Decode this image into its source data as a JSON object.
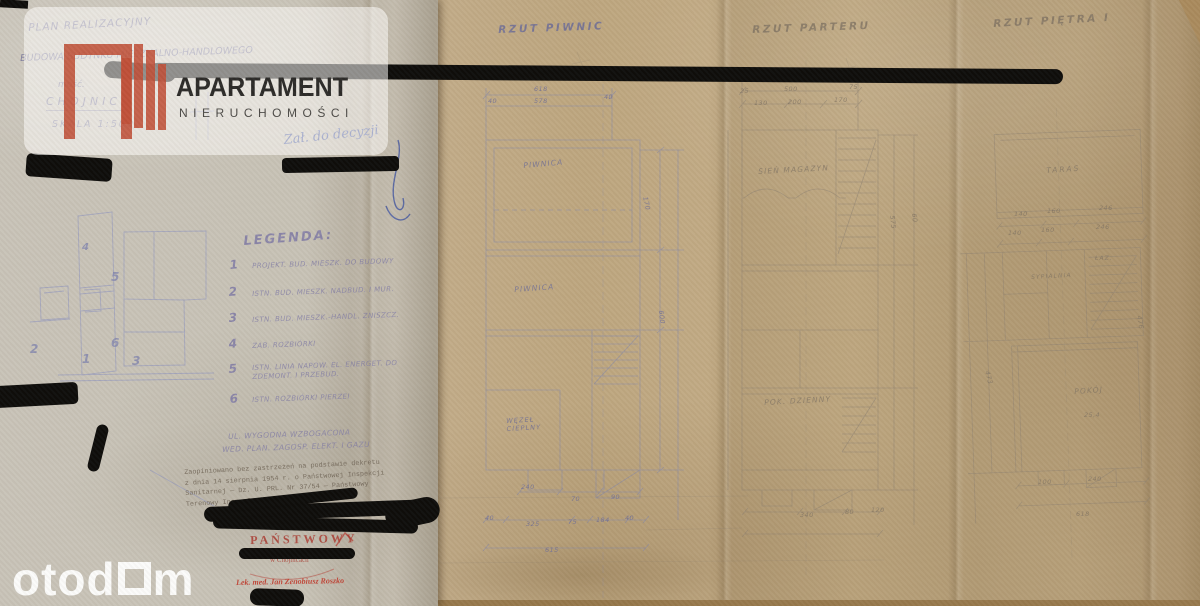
{
  "logo": {
    "title": "APARTAMENT",
    "subtitle": "NIERUCHOMOŚCI",
    "brand_color": "#bf4f37"
  },
  "footer_watermark": {
    "part1": "otod",
    "part2": "m",
    "full_name": "otodom"
  },
  "title_block": {
    "line1": "PLAN REALIZACYJNY",
    "line2": "BUDOWA BUDYNKU MIESZKALNO-HANDLOWEGO",
    "line3": "mość.",
    "line4": "CHOJNICE",
    "line5": "SKALA 1:500"
  },
  "ink_note": {
    "text": "Zał. do decyzji"
  },
  "legend": {
    "title": "LEGENDA:",
    "items": [
      {
        "num": "1",
        "text": "PROJEKT. BUD. MIESZK. DO BUDOWY"
      },
      {
        "num": "2",
        "text": "ISTN. BUD. MIESZK. NADBUD. I MUR."
      },
      {
        "num": "3",
        "text": "ISTN. BUD. MIESZK.-HANDL. ZNISZCZ."
      },
      {
        "num": "4",
        "text": "ZAB. ROZBIÓRKI"
      },
      {
        "num": "5",
        "text": "ISTN. LINIA NAPOW. EL. ENERGET. DO ZDEMONT. I PRZEBUD."
      },
      {
        "num": "6",
        "text": "ISTN. ROZBIÓRKI PIERZEI"
      }
    ],
    "footnote1": "UL. WYGODNA WZBOGACONA",
    "footnote2": "WED. PLAN. ZAGOSP. ELEKT. I GAZU"
  },
  "site_plan": {
    "labels": [
      "4",
      "5",
      "6",
      "1",
      "3",
      "2"
    ]
  },
  "plans": [
    {
      "title": "RZUT PIWNIC",
      "rooms": [
        "PIWNICA",
        "PIWNICA",
        "WĘZEŁ CIEPLNY"
      ],
      "dims": [
        "618",
        "578",
        "40",
        "40",
        "170",
        "600",
        "240",
        "70",
        "90",
        "40",
        "325",
        "75",
        "184",
        "40",
        "615"
      ]
    },
    {
      "title": "RZUT PARTERU",
      "rooms": [
        "SIEŃ MAGAZYN",
        "POK. DZIENNY"
      ],
      "dims": [
        "618",
        "500",
        "25",
        "75",
        "130",
        "200",
        "170",
        "575",
        "60",
        "340",
        "80",
        "120"
      ]
    },
    {
      "title": "RZUT PIĘTRA I",
      "rooms": [
        "TARAS",
        "SYPIALNIA",
        "ŁAZ.",
        "POKÓJ",
        "25,4"
      ],
      "dims": [
        "140",
        "160",
        "246",
        "140",
        "160",
        "246",
        "473",
        "476",
        "100",
        "240",
        "618"
      ]
    }
  ],
  "stamp_text": {
    "lines": [
      "Zaopiniowano bez zastrzeżeń na podstawie dekretu",
      "z dnia 14 sierpnia 1954 r. o Państwowej Inspekcji",
      "Sanitarnej — Dz. U. PRL. Nr 37/54 — Państwowy",
      "Terenowy Insp. Sanitarny"
    ]
  },
  "stamps": {
    "state": "PAŃSTWOWY",
    "city": "w Chojnicach",
    "doctor": "Lek. med. Jan Zenobiusz Roszko"
  },
  "colors": {
    "kraft_background": "#a98a5d",
    "sheet_left": "#c7c2b6",
    "sheet_main": "#bda67f",
    "pencil_blue": "#62659a",
    "pencil_brown": "#7c7061",
    "ink_blue": "#3a4f9f",
    "stamp_red": "#ab3d33",
    "marker_black": "#0d0c0a"
  }
}
